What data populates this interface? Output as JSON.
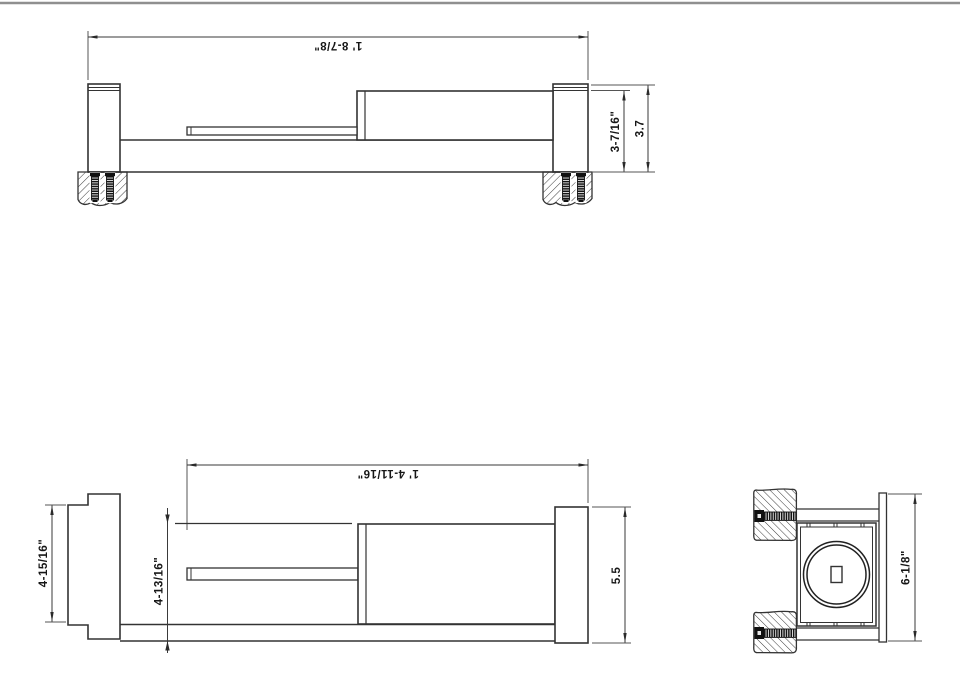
{
  "colors": {
    "object_line": "#333333",
    "dimension_line": "#4d4d4d",
    "text": "#161616",
    "sheet_border": "#8f8f8f",
    "background": "#ffffff",
    "bolt_fill": "#111111"
  },
  "side_view": {
    "dim_length": "1' 8-7/8\"",
    "dim_body_height": "3-7/16\"",
    "dim_overall_height": "3.7"
  },
  "plan_view": {
    "dim_length": "1' 4-11/16\"",
    "dim_end_plate_width": "4-15/16\"",
    "dim_carriage_width": "4-13/16\"",
    "dim_overall_width": "5.5"
  },
  "end_view": {
    "dim_overall_height": "6-1/8\""
  }
}
